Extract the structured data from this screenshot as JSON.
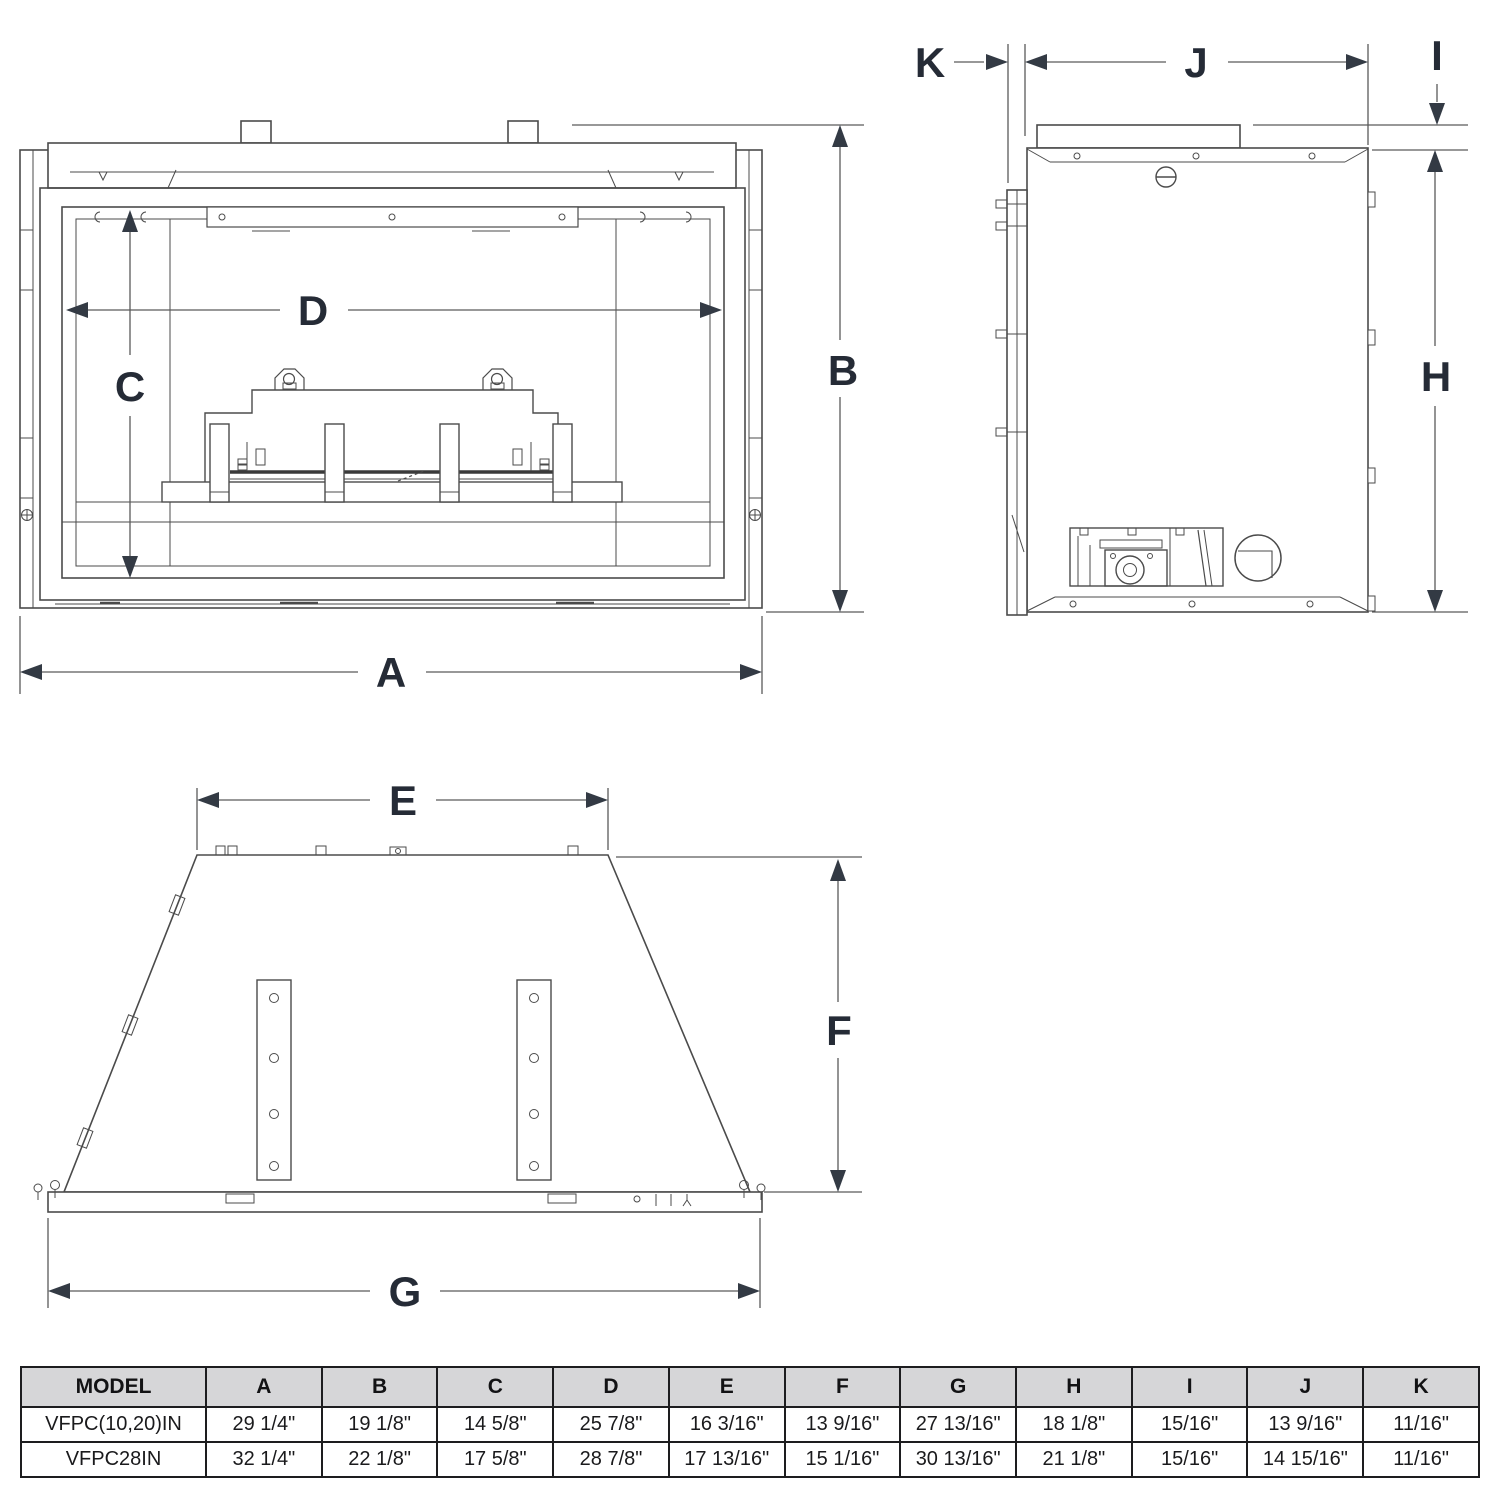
{
  "dims": {
    "A": "A",
    "B": "B",
    "C": "C",
    "D": "D",
    "E": "E",
    "F": "F",
    "G": "G",
    "H": "H",
    "I": "I",
    "J": "J",
    "K": "K"
  },
  "table": {
    "headers": [
      "MODEL",
      "A",
      "B",
      "C",
      "D",
      "E",
      "F",
      "G",
      "H",
      "I",
      "J",
      "K"
    ],
    "rows": [
      [
        "VFPC(10,20)IN",
        "29 1/4\"",
        "19 1/8\"",
        "14 5/8\"",
        "25 7/8\"",
        "16 3/16\"",
        "13 9/16\"",
        "27 13/16\"",
        "18 1/8\"",
        "15/16\"",
        "13 9/16\"",
        "11/16\""
      ],
      [
        "VFPC28IN",
        "32 1/4\"",
        "22 1/8\"",
        "17 5/8\"",
        "28 7/8\"",
        "17 13/16\"",
        "15 1/16\"",
        "30 13/16\"",
        "21 1/8\"",
        "15/16\"",
        "14 15/16\"",
        "11/16\""
      ]
    ]
  },
  "colors": {
    "line": "#4b4b4b",
    "dim_line": "#5a5a5a",
    "arrow": "#333a44",
    "letter": "#252b36",
    "table_header_bg": "#d6d6d8"
  }
}
